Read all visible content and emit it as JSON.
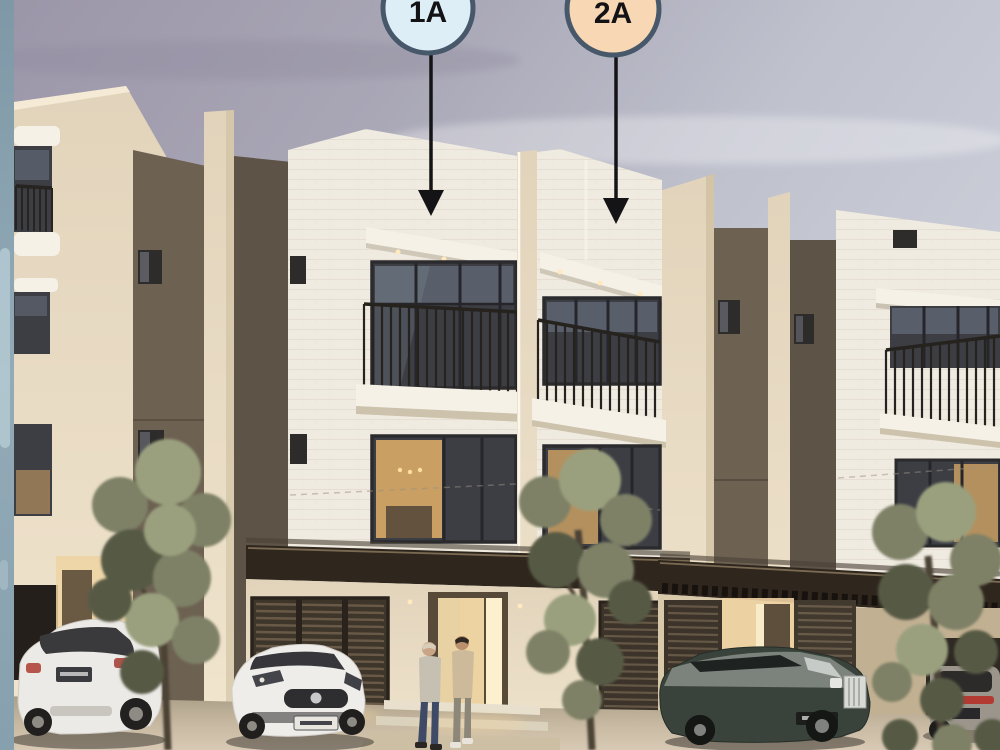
{
  "image": {
    "kind": "architectural-render",
    "description": "Dusk rendering of a row of three-storey brick townhouses with two labeled units, parked cars, young trees and two people walking to the entrance"
  },
  "markers": [
    {
      "id": "unit-1a",
      "label": "1A",
      "fill": "#ddeef6",
      "border": "#47586a"
    },
    {
      "id": "unit-2a",
      "label": "2A",
      "fill": "#f8d7b4",
      "border": "#47586a"
    }
  ],
  "palette": {
    "accent_strip": "#8ba3b1",
    "sky_top": "#9b95a8",
    "sky_light": "#ced0da",
    "brick_white": "#f0ebe1",
    "wall_cream": "#e8deca",
    "wall_brown": "#6d6152",
    "wall_brown_dark": "#5e5347",
    "canopy_dark": "#2f271e",
    "glass_dark": "#3c3e44",
    "glass_sky": "#707a8a",
    "warm_light": "#eed3a2",
    "warm_interior": "#c99f63",
    "railing_dark": "#26231f",
    "foliage_mid": "#7e8166",
    "foliage_light": "#9aa07e",
    "foliage_dark": "#575a45",
    "trunk": "#4b4236",
    "ground": "#c5b79f",
    "marker_border": "#47586a",
    "arrow_black": "#141416"
  },
  "scene": {
    "units_labeled": [
      "1A",
      "2A"
    ],
    "people_count": 2,
    "trees_count": 3,
    "cars": [
      "white-suv",
      "white-sedan",
      "dark-luxury-sedan",
      "grey-car-in-garage"
    ]
  }
}
